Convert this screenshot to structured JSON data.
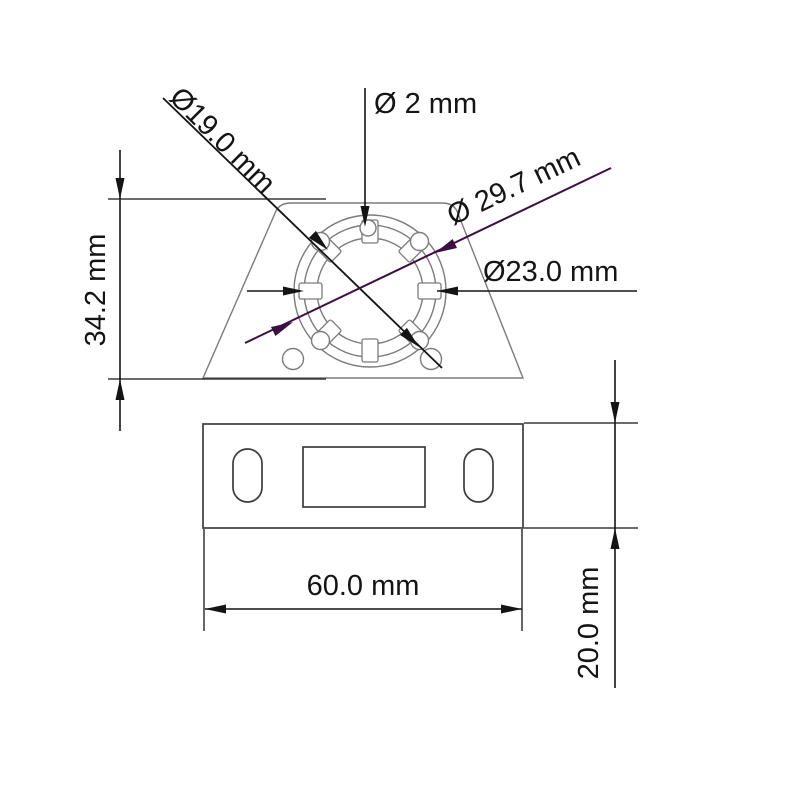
{
  "meta": {
    "type": "technical-drawing",
    "unit": "mm",
    "view_count": 2
  },
  "palette": {
    "dimension_color": "#141414",
    "highlight_color": "#3d0e42",
    "outline_color": "#7b7b7b",
    "plate_outline_color": "#3c3c3c",
    "background": "#ffffff"
  },
  "views": {
    "top_view": {
      "name": "top view - trapezoid body with castellated ring",
      "features": [
        "trapezoid-body",
        "outer-circle",
        "castellated-ring",
        "pilot-bump",
        "four-ring-holes",
        "two-corner-holes"
      ]
    },
    "front_view": {
      "name": "front view - mounting plate",
      "features": [
        "plate-outline",
        "left-mounting-slot",
        "right-mounting-slot",
        "center-cutout"
      ]
    }
  },
  "dimensions": {
    "bore": {
      "label": "Ø19.0 mm",
      "value": 19.0,
      "unit": "mm",
      "kind": "diameter"
    },
    "pilot_hole": {
      "label": "Ø 2 mm",
      "value": 2,
      "unit": "mm",
      "kind": "diameter"
    },
    "outer_diameter": {
      "label": "Ø 29.7 mm",
      "value": 29.7,
      "unit": "mm",
      "kind": "diameter"
    },
    "ring_diameter": {
      "label": "Ø23.0 mm",
      "value": 23.0,
      "unit": "mm",
      "kind": "diameter"
    },
    "body_height": {
      "label": "34.2 mm",
      "value": 34.2,
      "unit": "mm",
      "kind": "linear-vertical"
    },
    "plate_width": {
      "label": "60.0 mm",
      "value": 60.0,
      "unit": "mm",
      "kind": "linear-horizontal"
    },
    "plate_height": {
      "label": "20.0 mm",
      "value": 20.0,
      "unit": "mm",
      "kind": "linear-vertical"
    }
  }
}
